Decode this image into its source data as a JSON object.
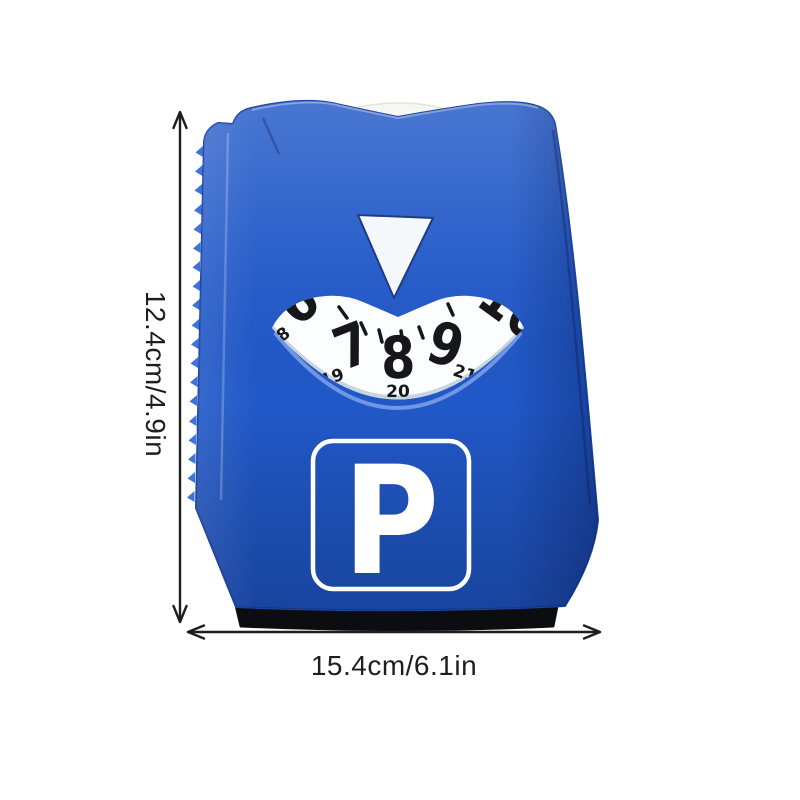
{
  "annotations": {
    "height_label": "12.4cm/4.9in",
    "width_label": "15.4cm/6.1in"
  },
  "disc": {
    "parking_symbol": "P",
    "dial": {
      "big_numbers": [
        "6",
        "7",
        "8",
        "9",
        "10"
      ],
      "small_numbers": [
        "8",
        "19",
        "20",
        "21"
      ]
    }
  },
  "colors": {
    "body_blue": "#2158C8",
    "body_blue_light": "#3E73DB",
    "body_blue_dark": "#16419E",
    "dial_white": "#FBFDFE",
    "dial_text": "#17171B",
    "pointer_white": "#F4F8FB",
    "sign_white": "#FFFFFF",
    "base_black": "#0C0D11",
    "annotation_dark": "#1E1E1E"
  }
}
